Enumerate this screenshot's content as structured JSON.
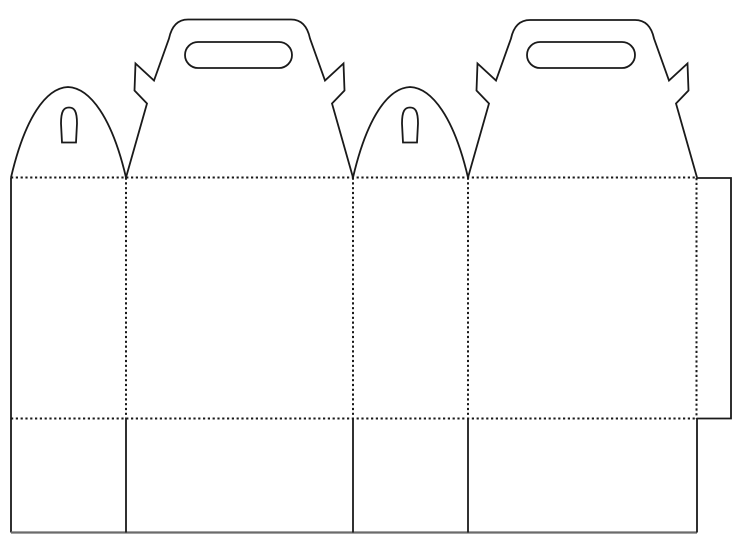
{
  "canvas": {
    "width": 735,
    "height": 549,
    "viewbox": "0 0 735 549",
    "background_color": "#ffffff",
    "line_color": "#1a1a1a",
    "bottom_edge_color": "#6b6b6b"
  },
  "line_styles": {
    "cut": {
      "stroke_width": 1.8,
      "dash": ""
    },
    "fold": {
      "stroke_width": 2.0,
      "dash": "2.2 2.6"
    },
    "bottom_edge": {
      "stroke_width": 2.2
    }
  },
  "layout": {
    "left_edge_x": 11,
    "top_fold_y": 177.5,
    "bottom_fold_y": 418.5,
    "bottom_edge_y": 532.5,
    "panel_boundaries_x": [
      11,
      126,
      353,
      468,
      697
    ],
    "glue_tab": {
      "left_x": 696.5,
      "right_x": 731,
      "top_y": 178,
      "bottom_y": 418.5
    }
  },
  "arch_flaps": [
    {
      "base_x1": 11,
      "base_x2": 126,
      "peak_x": 68,
      "peak_y": 87,
      "slot": {
        "x1": 61,
        "x2": 77,
        "top_y": 107.5,
        "bottom_y": 142.5
      }
    },
    {
      "base_x1": 353,
      "base_x2": 468,
      "peak_x": 410,
      "peak_y": 87,
      "slot": {
        "x1": 402,
        "x2": 418,
        "top_y": 107.5,
        "bottom_y": 142.5
      }
    }
  ],
  "gable_flaps": [
    {
      "x1": 126,
      "x2": 353,
      "top_y": 19.5,
      "handle": {
        "x1": 185,
        "x2": 292,
        "y1": 42,
        "y2": 68
      }
    },
    {
      "x1": 468,
      "x2": 697,
      "top_y": 20,
      "handle": {
        "x1": 527,
        "x2": 635,
        "y1": 42,
        "y2": 68
      }
    }
  ],
  "gable_profile": {
    "ear_offsets": [
      [
        21,
        -74
      ],
      [
        8.5,
        -87
      ],
      [
        9.5,
        -114
      ],
      [
        28,
        -97
      ]
    ],
    "upper_slope_offset": [
      43,
      -139
    ],
    "top_corner_inset": 62,
    "top_corner_ctrl_inset": 47
  }
}
